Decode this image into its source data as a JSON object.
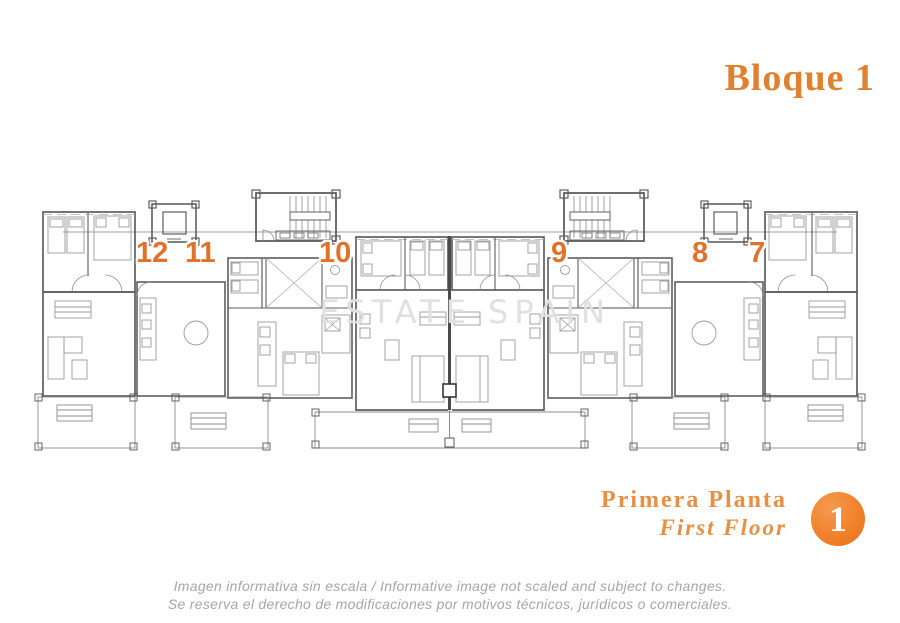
{
  "header": {
    "block_title": "Bloque 1"
  },
  "plan": {
    "watermark": "ESTATE SPAIN",
    "unit_numbers": [
      "12",
      "11",
      "10",
      "9",
      "8",
      "7"
    ]
  },
  "floor": {
    "label_es": "Primera Planta",
    "label_en": "First Floor",
    "number": "1"
  },
  "disclaimer": {
    "line1": "Imagen informativa sin escala /  Informative image not scaled and subject to changes.",
    "line2": "Se reserva el derecho de modificaciones por motivos técnicos, jurídicos o comerciales."
  },
  "colors": {
    "accent_title": "#DF812F",
    "accent_numbers": "#E0732C",
    "accent_floor_label": "#E79043",
    "floor_circle": "#EF7D26",
    "watermark": "#E0E0E0",
    "disclaimer_text": "#A6A6A6",
    "plan_walls": "#5F5F5F"
  }
}
